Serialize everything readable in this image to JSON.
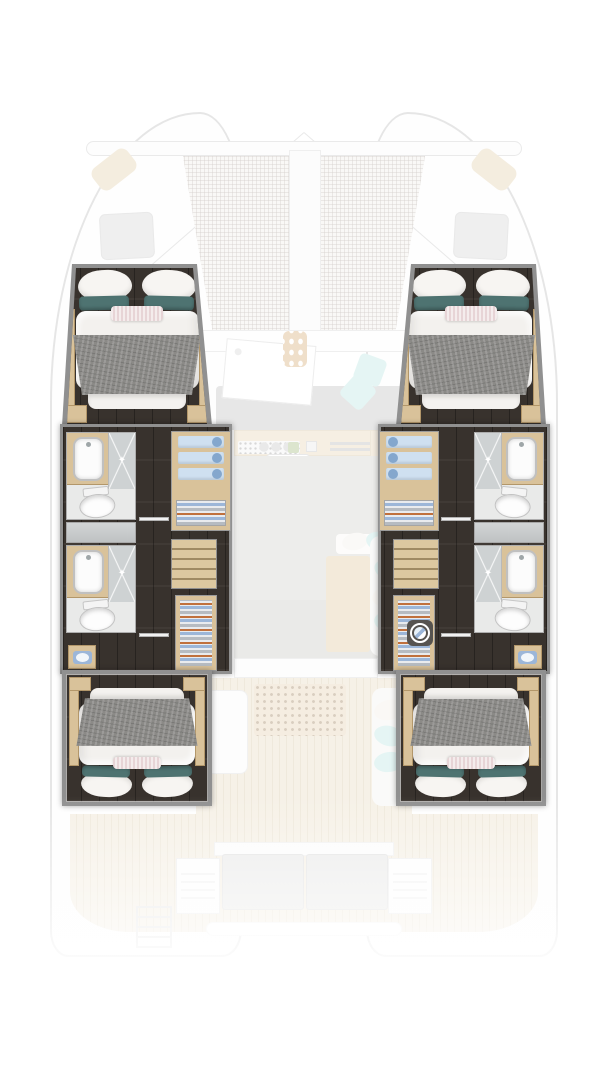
{
  "icons": {
    "sparkle": "✦"
  },
  "palette": {
    "wall": "#909090",
    "floorDark": "#38322d",
    "wood": "#d9c29a",
    "woodEdge": "#b3976a",
    "bathFloor": "#e9eae9",
    "shower": "#ced2d3",
    "duvet": "#f3f1ee",
    "blanket": "#8b8a87",
    "teal": "#4e7371",
    "pink": "#e7d4d6",
    "towel": "#cfe0f0",
    "roll": "#84a7cd",
    "orange": "#c0703c",
    "clothesBlue": "#9cb6d8",
    "clothesGrey": "#b6bbc1",
    "aqua": "#c6ebe7",
    "sofa": "#cccccc",
    "floorGrey": "#d9d8d5",
    "teak": "#ece1cc",
    "teakLine": "#ddcfb2",
    "hullLine": "#c9c9c9",
    "washer": "#56534f"
  },
  "visible_features": {
    "double_bed_cabins": 4,
    "bathrooms": 4,
    "showers": 4,
    "toilets": 4,
    "washbasins": 6,
    "wardrobes": 4,
    "staircases": 2,
    "washing_machine": 1,
    "bow_trampoline": true,
    "galley": true,
    "saloon": true,
    "aft_cockpit_bench": true
  }
}
